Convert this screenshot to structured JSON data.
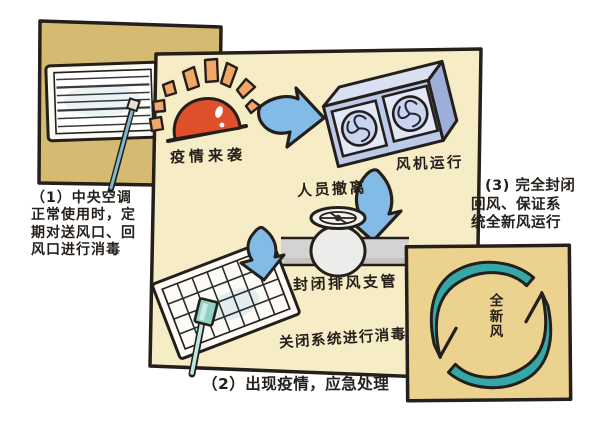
{
  "figure_title": "中央空调疫情防控流程示意图",
  "panel1": {
    "caption_lines": [
      "（1）中央空调",
      "正常使用时，定",
      "期对送风口、回",
      "风口进行消毒"
    ]
  },
  "panel2": {
    "alarm_label": "疫情来袭",
    "fan_label": "风机运行",
    "evacuate_label": "人员撤离",
    "valve_label": "封闭排风支管",
    "disinfect_label": "关闭系统进行消毒",
    "caption": "（2）出现疫情，应急处理"
  },
  "panel3": {
    "caption_lines": [
      "(3) 完全封闭",
      "回风、保证系",
      "统全新风运行"
    ],
    "fresh_air_label": "全新风"
  },
  "colors": {
    "background": "#ffffff",
    "panel1_fill": "#d5bb72",
    "panel2_fill": "#f6ecc5",
    "panel3_fill": "#ecd28f",
    "outline": "#241f1b",
    "alarm_red": "#df4f2b",
    "ray_orange": "#f2a76a",
    "arrow_blue": "#83bbe7",
    "fan_blue": "#bccaea",
    "pipe_gray": "#d3d3d1",
    "spray_teal": "#8fd2c8",
    "cycle_teal": "#35a7a6"
  }
}
